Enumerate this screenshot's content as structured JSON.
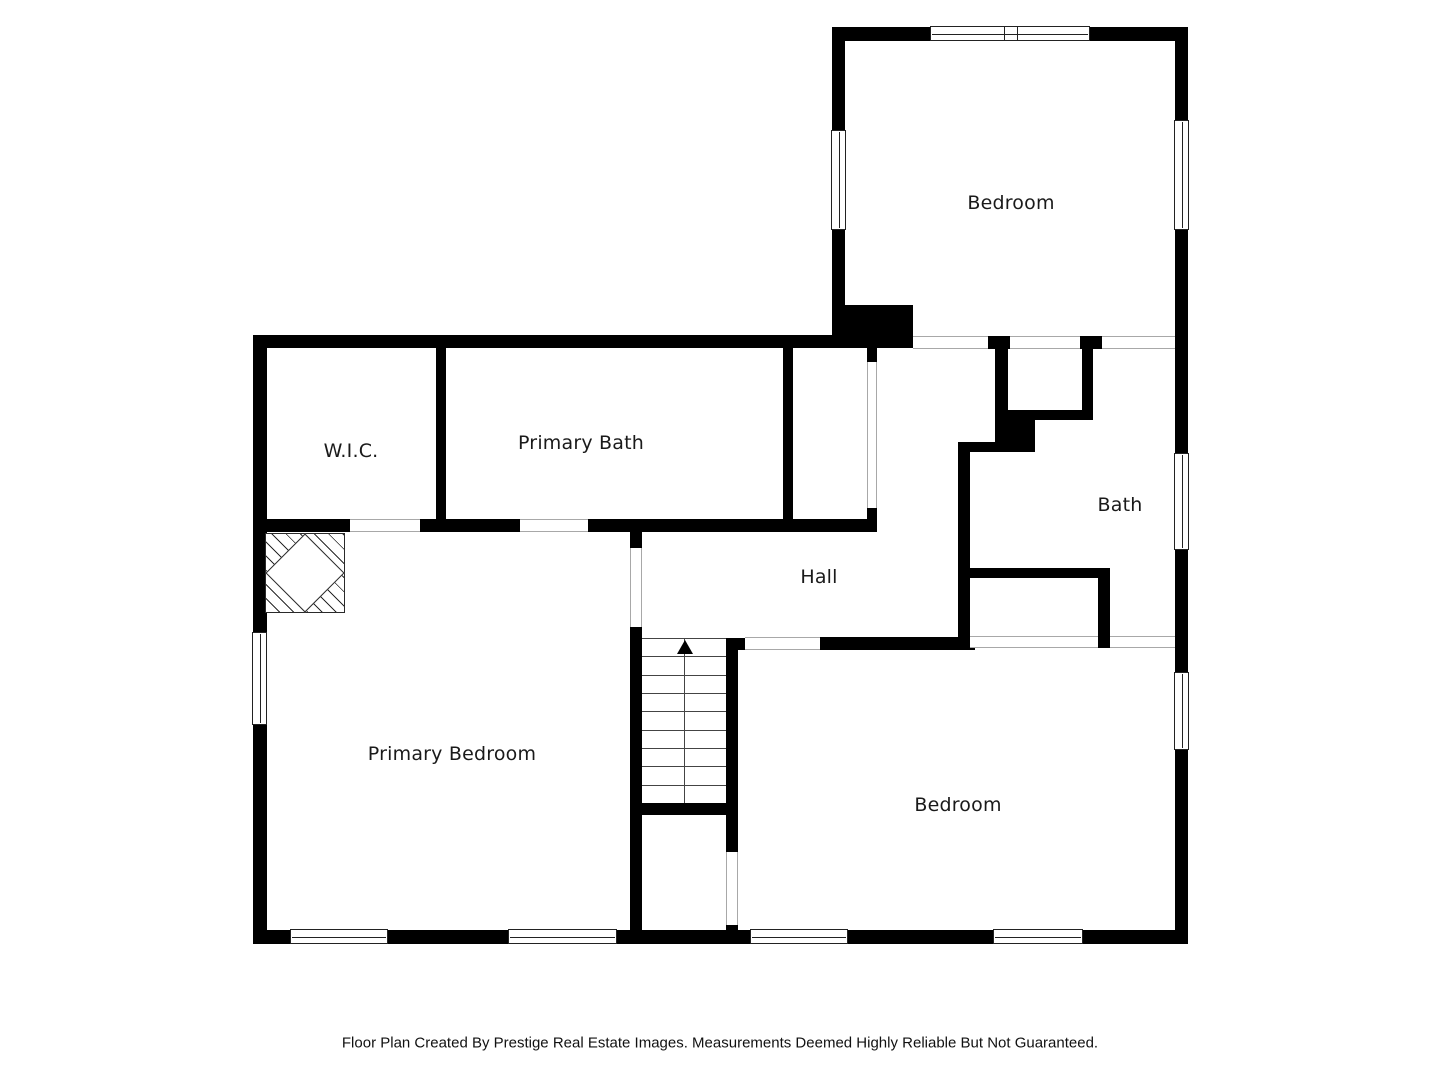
{
  "title": "Second Floor Plan",
  "colors": {
    "wall": "#000000",
    "background": "#ffffff",
    "opening_line": "#a8a8a8",
    "stair_line": "#444444",
    "window_border": "#222222",
    "label": "#1a1a1a"
  },
  "rooms": [
    {
      "id": "bedroom-top",
      "label": "Bedroom"
    },
    {
      "id": "wic",
      "label": "W.I.C."
    },
    {
      "id": "primary-bath",
      "label": "Primary Bath"
    },
    {
      "id": "hall",
      "label": "Hall"
    },
    {
      "id": "bath",
      "label": "Bath"
    },
    {
      "id": "primary-bedroom",
      "label": "Primary Bedroom"
    },
    {
      "id": "bedroom-bottom",
      "label": "Bedroom"
    }
  ],
  "stairs": {
    "direction": "up",
    "icon": "up-arrow",
    "visible_steps": 9
  },
  "features": {
    "chimney": "hatched chimney chase with flue diamond",
    "windows": 10,
    "door_openings": 11
  },
  "footer": {
    "text": "Floor Plan Created By Prestige Real Estate Images. Measurements Deemed Highly Reliable But Not Guaranteed."
  }
}
